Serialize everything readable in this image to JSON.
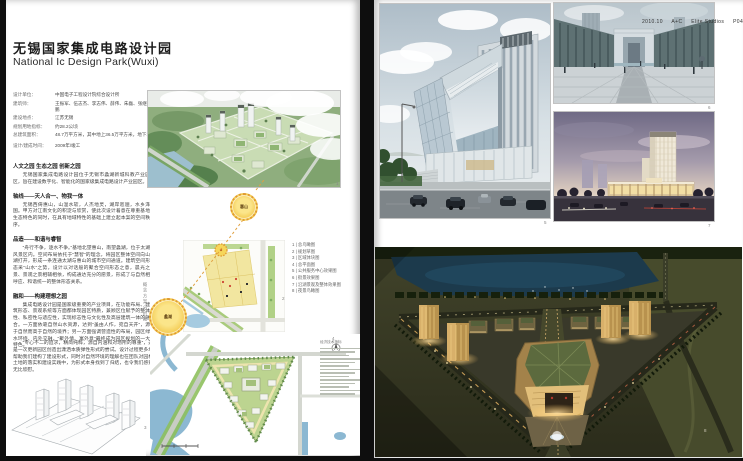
{
  "doc": {
    "header_meta": {
      "date": "2010.10",
      "brand": "A+C",
      "studio": "Elite Studios",
      "page": "P049"
    },
    "left": {
      "title_cn": "无锡国家集成电路设计园",
      "title_en": "National Ic Design Park(Wuxi)",
      "info": [
        {
          "label": "设计单位：",
          "value": "中国电子工程设计院综合设计所"
        },
        {
          "label": "建筑师：",
          "value": "王振军、伍志杰、李志伟、薛伟、朱磊、张继强、王军、钱鹏"
        },
        {
          "label": "建设地点：",
          "value": "江苏无锡"
        },
        {
          "label": "规划用地指标：",
          "value": "约28.2公顷"
        },
        {
          "label": "总建筑面积：",
          "value": "48.7万平方米，其中地上36.5万平方米，地下16.2万平方米"
        },
        {
          "label": "设计/建成时间：",
          "value": "2009年/竣工"
        }
      ],
      "sections": [
        {
          "heading": "人文之园 生态之园 创新之园",
          "body": "无锡国家集成电路设计园位于无锡市蠡湖新城科教产业园区，旨在建设数字化、智能化的国家级集成电路设计产业园区。"
        },
        {
          "heading": "轴线——天人合一、物我一体",
          "body": "无锡西倚惠山，山温水软，人杰地灵，湖岸迤逦，水乡泽国。甲方对江南文化的积淀与欣赏，使此次设计着意在尊重基地生态特色的同时，在具有地域特性的基础上建立起本案的空间秩序。"
        },
        {
          "heading": "品造——和谐与睿智",
          "body": "“舟行不争，逐水不争。”基地北望惠山，南望蠡湖，位于太湖风景区内。空间布局依托于“慧智”的理念，将园区整体空间向山湖打开，形成一条连通太湖与惠山的城市空间通道。建筑空间形态采“山水”之势，设计以对话般的聚合空间形态之意，晨光之景、景观之景相辅相依，构成通达充分的愿景，形成了与自然相呼应、和谐统一的整体形态关系。"
        },
        {
          "heading": "融和——构建理想之园",
          "body": "集成电路设计园是国家级重要的产业项目，在功能布局、建筑形态、景观系统等方面都体现园区特质，兼顾区位赋予的整体性、私密性与适应性，实现标志性与文化性及高层建筑一体的融合。一方面依靠自然山水资源，达到“虽由人作，宛自天开”，源于自然而高于自然的境界；另一方面强调营造性的布局，园区绿水环绕、内外交融，“聚外情、寓外意”最终成为园区规划的一大特色。"
        }
      ],
      "closing": "“专心不二的追求，精简纯粹，源自内涵和对场所的尊重”，这是一次更新园区创造出潇洒本质弹性形式的尝试。设计过程更多地帮助我们建构了建设形式，同时对自然环境的理解也在团队对园林土地的落实和建设实践中，为形式本身找到了归结，也令我们感到无比欣慰。",
      "vertical_caption": "概念方案分析图",
      "master_plan_caption": "经济技术指标",
      "legend": [
        "1 | 总鸟瞰图",
        "2 | 规划草图",
        "3 | 区域体块图",
        "4 | 总平面图",
        "5 | 公共服务中心效果图",
        "6 | 街景效果图",
        "7 | 沿湖景观及整体效果图",
        "8 | 夜景鸟瞰图"
      ],
      "axis_markers": {
        "start": "惠山",
        "end": "蠡湖"
      },
      "fig_nums": {
        "aerial": "1",
        "site_plan": "2",
        "sketch": "3",
        "master_plan": "4"
      }
    },
    "right": {
      "fig_nums": {
        "gate": "5",
        "plaza": "6",
        "dusk": "7",
        "night": "8"
      }
    },
    "colors": {
      "accent_sun": "#f0c23c",
      "axis_dash": "#e0a040",
      "page_bg": "#ffffff",
      "frame_bg": "#0e0e0e"
    }
  }
}
